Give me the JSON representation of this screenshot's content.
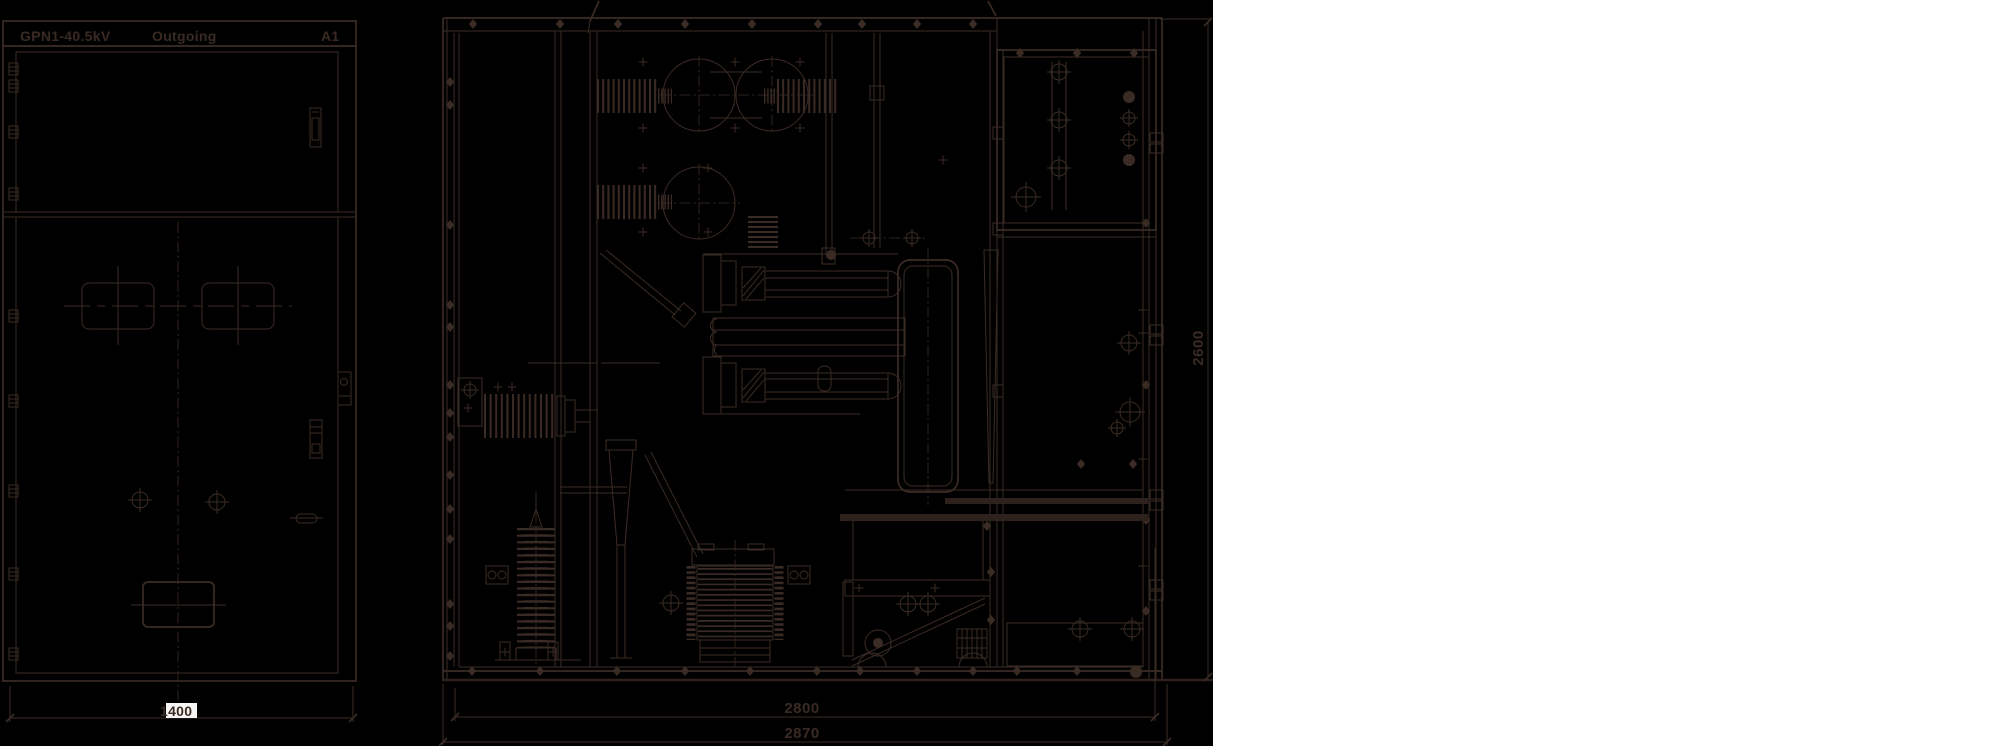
{
  "colors": {
    "line": "#3b2b25",
    "strong": "#2e211c",
    "text": "#3a2a24",
    "bg": "#000000",
    "page": "#ffffff",
    "highlight": "#f7f6f4"
  },
  "front_view": {
    "title": "GPN1-40.5kV",
    "subtitle": "Outgoing",
    "panel_code": "A1",
    "width_dimension": "1400"
  },
  "section_view": {
    "inner_width_dimension": "2800",
    "overall_width_dimension": "2870",
    "height_dimension": "2600"
  }
}
